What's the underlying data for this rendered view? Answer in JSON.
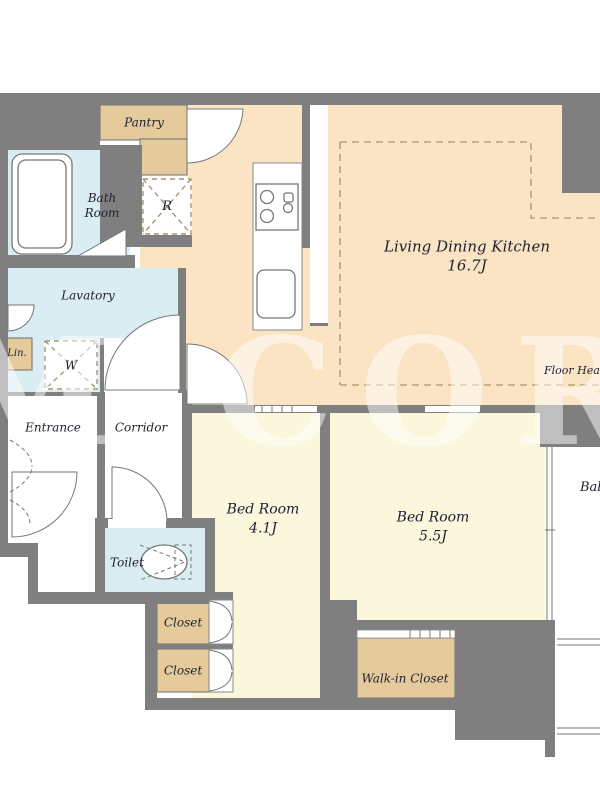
{
  "title": "Apartment Floor Plan",
  "watermark_text": "RM CORP",
  "colors": {
    "wall": "#7f7f7f",
    "ldk": "#fae4c3",
    "bedroom": "#faf7dc",
    "wet": "#d9edf3",
    "storage": "#e5cb9b",
    "line": "#777777",
    "hatch": "#a59372",
    "heat_dash": "#bca077",
    "text": "#222233",
    "watermark": "rgba(255,255,255,0.5)"
  },
  "rooms": {
    "pantry": {
      "label": "Pantry"
    },
    "bath": {
      "label": "Bath\nRoom"
    },
    "refrigerator": {
      "label": "R"
    },
    "ldk": {
      "label": "Living Dining Kitchen",
      "size": "16.7J"
    },
    "floor_heating": {
      "label": "Floor Heating"
    },
    "lavatory": {
      "label": "Lavatory"
    },
    "linen": {
      "label": "Lin."
    },
    "washer": {
      "label": "W"
    },
    "entrance": {
      "label": "Entrance"
    },
    "corridor": {
      "label": "Corridor"
    },
    "toilet": {
      "label": "Toilet"
    },
    "bedroom1": {
      "label": "Bed Room",
      "size": "4.1J"
    },
    "bedroom2": {
      "label": "Bed Room",
      "size": "5.5J"
    },
    "closet1": {
      "label": "Closet"
    },
    "closet2": {
      "label": "Closet"
    },
    "walkin": {
      "label": "Walk-in Closet"
    },
    "balcony": {
      "label": "Balcony"
    }
  }
}
